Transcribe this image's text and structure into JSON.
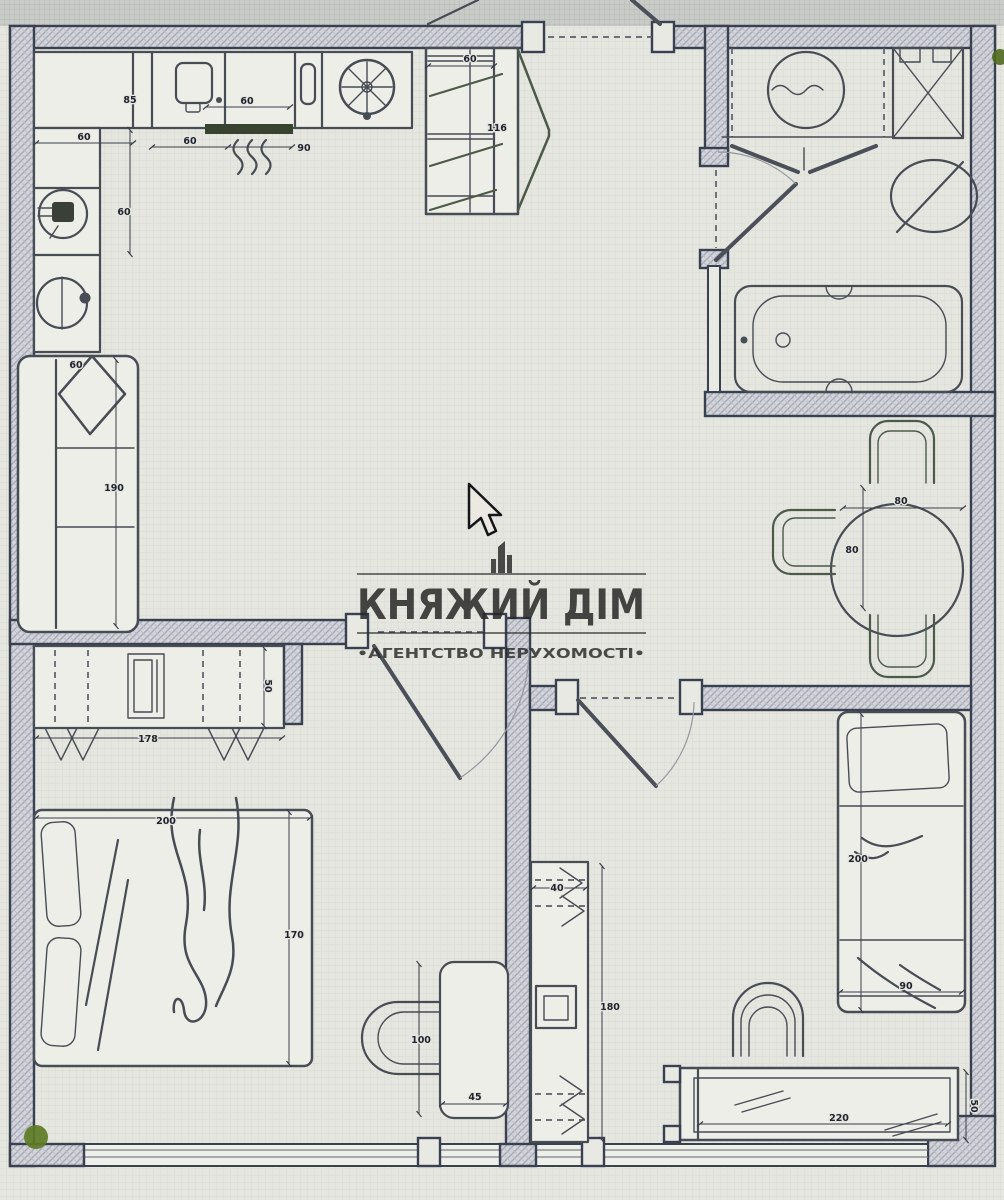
{
  "page": {
    "type": "apartment-floor-plan-photo"
  },
  "watermark": {
    "title": "КНЯЖИЙ ДІМ",
    "subtitle": "•АГЕНТСТВО НЕРУХОМОСТІ•",
    "logo_icon": "highrise-building-icon"
  },
  "colors": {
    "paper": "#e6e6e0",
    "outside_band": "#c9cbc8",
    "wall_fill": "#d3d5da",
    "wall_stroke": "#394050",
    "line": "#474c55",
    "furniture_green": "#4d5a49",
    "accent_green": "#5d7b24",
    "dim_text": "#20242e"
  },
  "dims": {
    "kitchen": {
      "counter_section": "85",
      "hob_width": "60",
      "left_counter_width": "60",
      "mid_section": "60",
      "right_section": "90",
      "left_depth": "60"
    },
    "hall_wardrobe": {
      "width": "60",
      "depth": "116"
    },
    "living": {
      "sofa_arm": "60",
      "sofa_length": "190"
    },
    "dining": {
      "table_width": "80",
      "table_depth": "80"
    },
    "bedroom": {
      "wardrobe_depth": "50",
      "wardrobe_width": "178",
      "bed_length": "200",
      "bed_width": "170",
      "desk_length": "100",
      "desk_depth": "45"
    },
    "kids_room": {
      "wardrobe_depth": "40",
      "wardrobe_length": "180",
      "bed_length": "200",
      "bed_width": "90",
      "desk_length": "220",
      "desk_depth": "50"
    }
  },
  "icons": [
    "kitchen-sink-icon",
    "hob-icon",
    "extractor-fan-icon",
    "radiator-icon",
    "round-sink-icon",
    "washing-machine-icon",
    "shower-cabin-icon",
    "washbasin-icon",
    "bathtub-icon",
    "sofa-icon",
    "pillow-icon",
    "dining-table-icon",
    "chair-icon",
    "double-bed-icon",
    "single-bed-icon",
    "wardrobe-icon",
    "desk-icon",
    "stool-icon",
    "tv-unit-icon",
    "door-swing-icon",
    "cursor-arrow-icon",
    "plant-icon"
  ]
}
